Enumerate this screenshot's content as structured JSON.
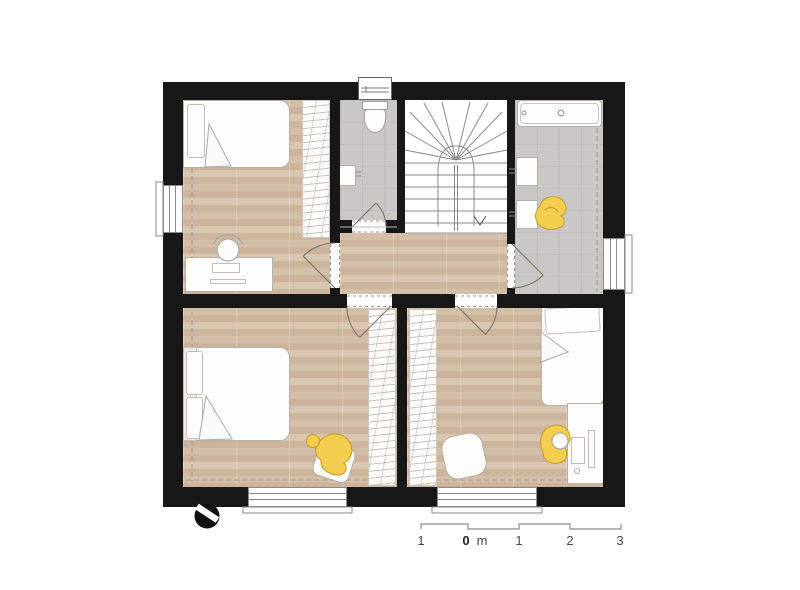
{
  "plan": {
    "type": "architectural-floor-plan",
    "colors": {
      "wall": "#171717",
      "wood_floor": "#cfb89f",
      "tile_floor": "#c9c8c4",
      "furniture": "#fdfdfc",
      "outline": "#a9a49c",
      "figure_yellow": "#f3cd4e",
      "figure_yellow_outline": "#c9992a"
    },
    "north_indicator": "compass-circle-icon",
    "scale_bar": {
      "unit": "m",
      "labels": [
        "1",
        "0",
        "m",
        "1",
        "2",
        "3"
      ]
    },
    "rooms": [
      {
        "id": "bedroom-nw",
        "fixtures": [
          "bed",
          "pillow",
          "desk",
          "office-chair",
          "keyboard",
          "monitor",
          "wardrobe",
          "window"
        ]
      },
      {
        "id": "wc",
        "fixtures": [
          "toilet",
          "washbasin",
          "chimney",
          "door"
        ]
      },
      {
        "id": "staircase",
        "fixtures": [
          "winder-stair",
          "direction-arrow"
        ]
      },
      {
        "id": "bathroom",
        "fixtures": [
          "bathtub",
          "washbasin",
          "washbasin",
          "person-figure",
          "window",
          "door"
        ]
      },
      {
        "id": "hallway",
        "fixtures": [
          "door",
          "door",
          "door",
          "door"
        ]
      },
      {
        "id": "bedroom-sw",
        "fixtures": [
          "bed-double",
          "pillow",
          "pillow",
          "wardrobe",
          "person-figure",
          "floor-cushion",
          "window"
        ]
      },
      {
        "id": "bedroom-se",
        "fixtures": [
          "bed-single",
          "pillow",
          "desk",
          "desk-chair",
          "person-figure",
          "pouf",
          "wardrobe",
          "window"
        ]
      }
    ]
  }
}
